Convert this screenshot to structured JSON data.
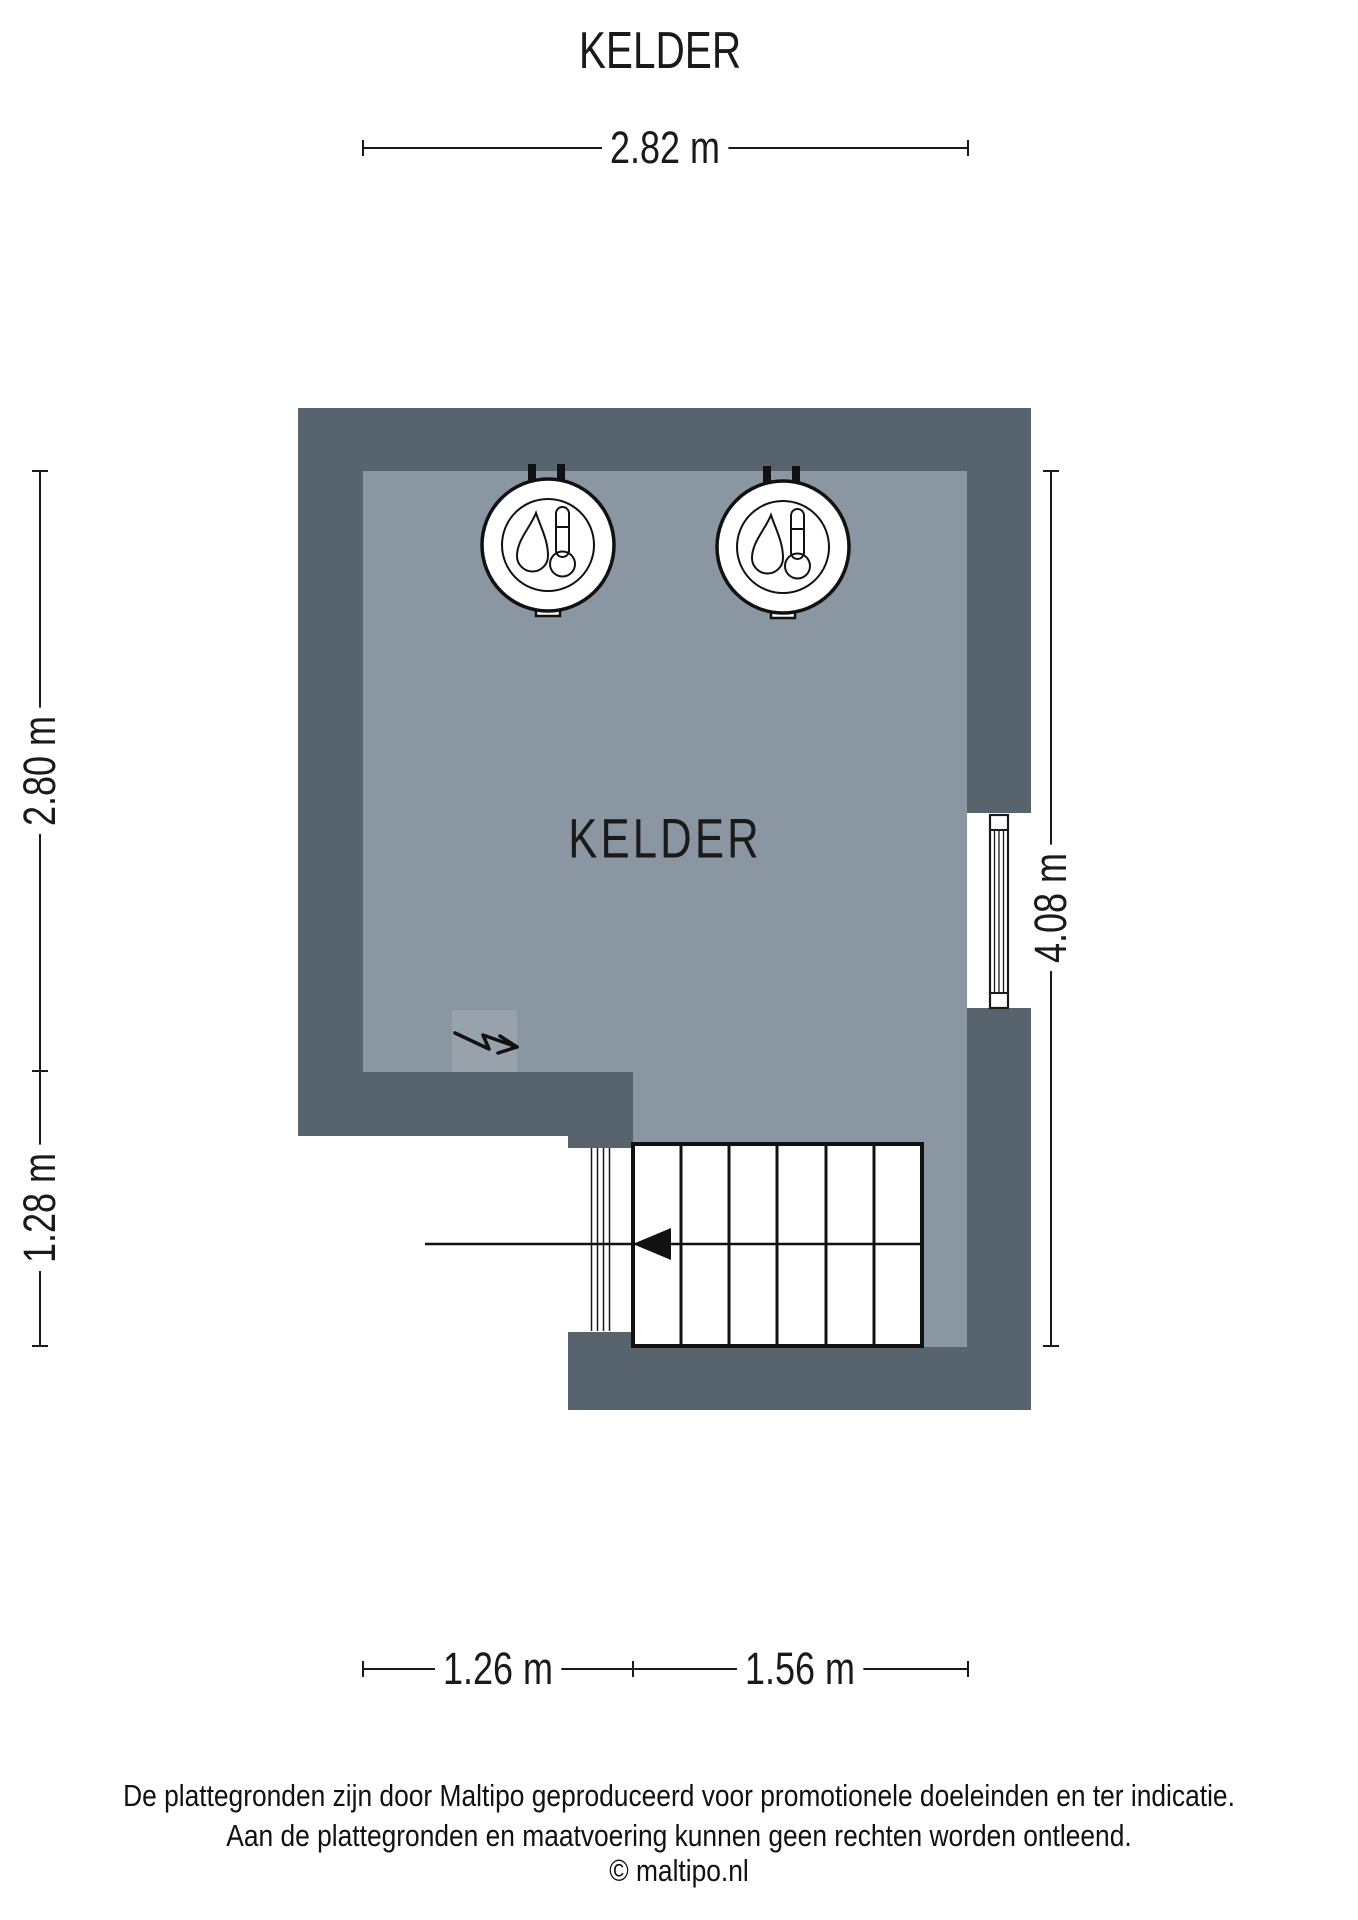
{
  "title": "KELDER",
  "room": {
    "label": "KELDER"
  },
  "dimensions": {
    "top": "2.82 m",
    "left_upper": "2.80 m",
    "left_lower": "1.28 m",
    "right": "4.08 m",
    "bottom_left": "1.26 m",
    "bottom_right": "1.56 m"
  },
  "icons": {
    "boiler": "boiler-icon (flame + thermometer in circle)",
    "lightning": "electricity-connection-icon (zigzag arrow)",
    "window": "window-icon (glazed frame in wall opening)",
    "stairs": "stairs-icon (treads with walk-line arrow)"
  },
  "colors": {
    "wall": "#57646E",
    "floor": "#8A96A1",
    "floor_highlight": "#97A2AC",
    "line": "#1A1A1A",
    "background": "#FFFFFF"
  },
  "footer": {
    "line1": "De plattegronden zijn door Maltipo geproduceerd voor promotionele doeleinden en ter indicatie.",
    "line2": "Aan de plattegronden en maatvoering kunnen geen rechten worden ontleend.",
    "line3": "© maltipo.nl"
  }
}
